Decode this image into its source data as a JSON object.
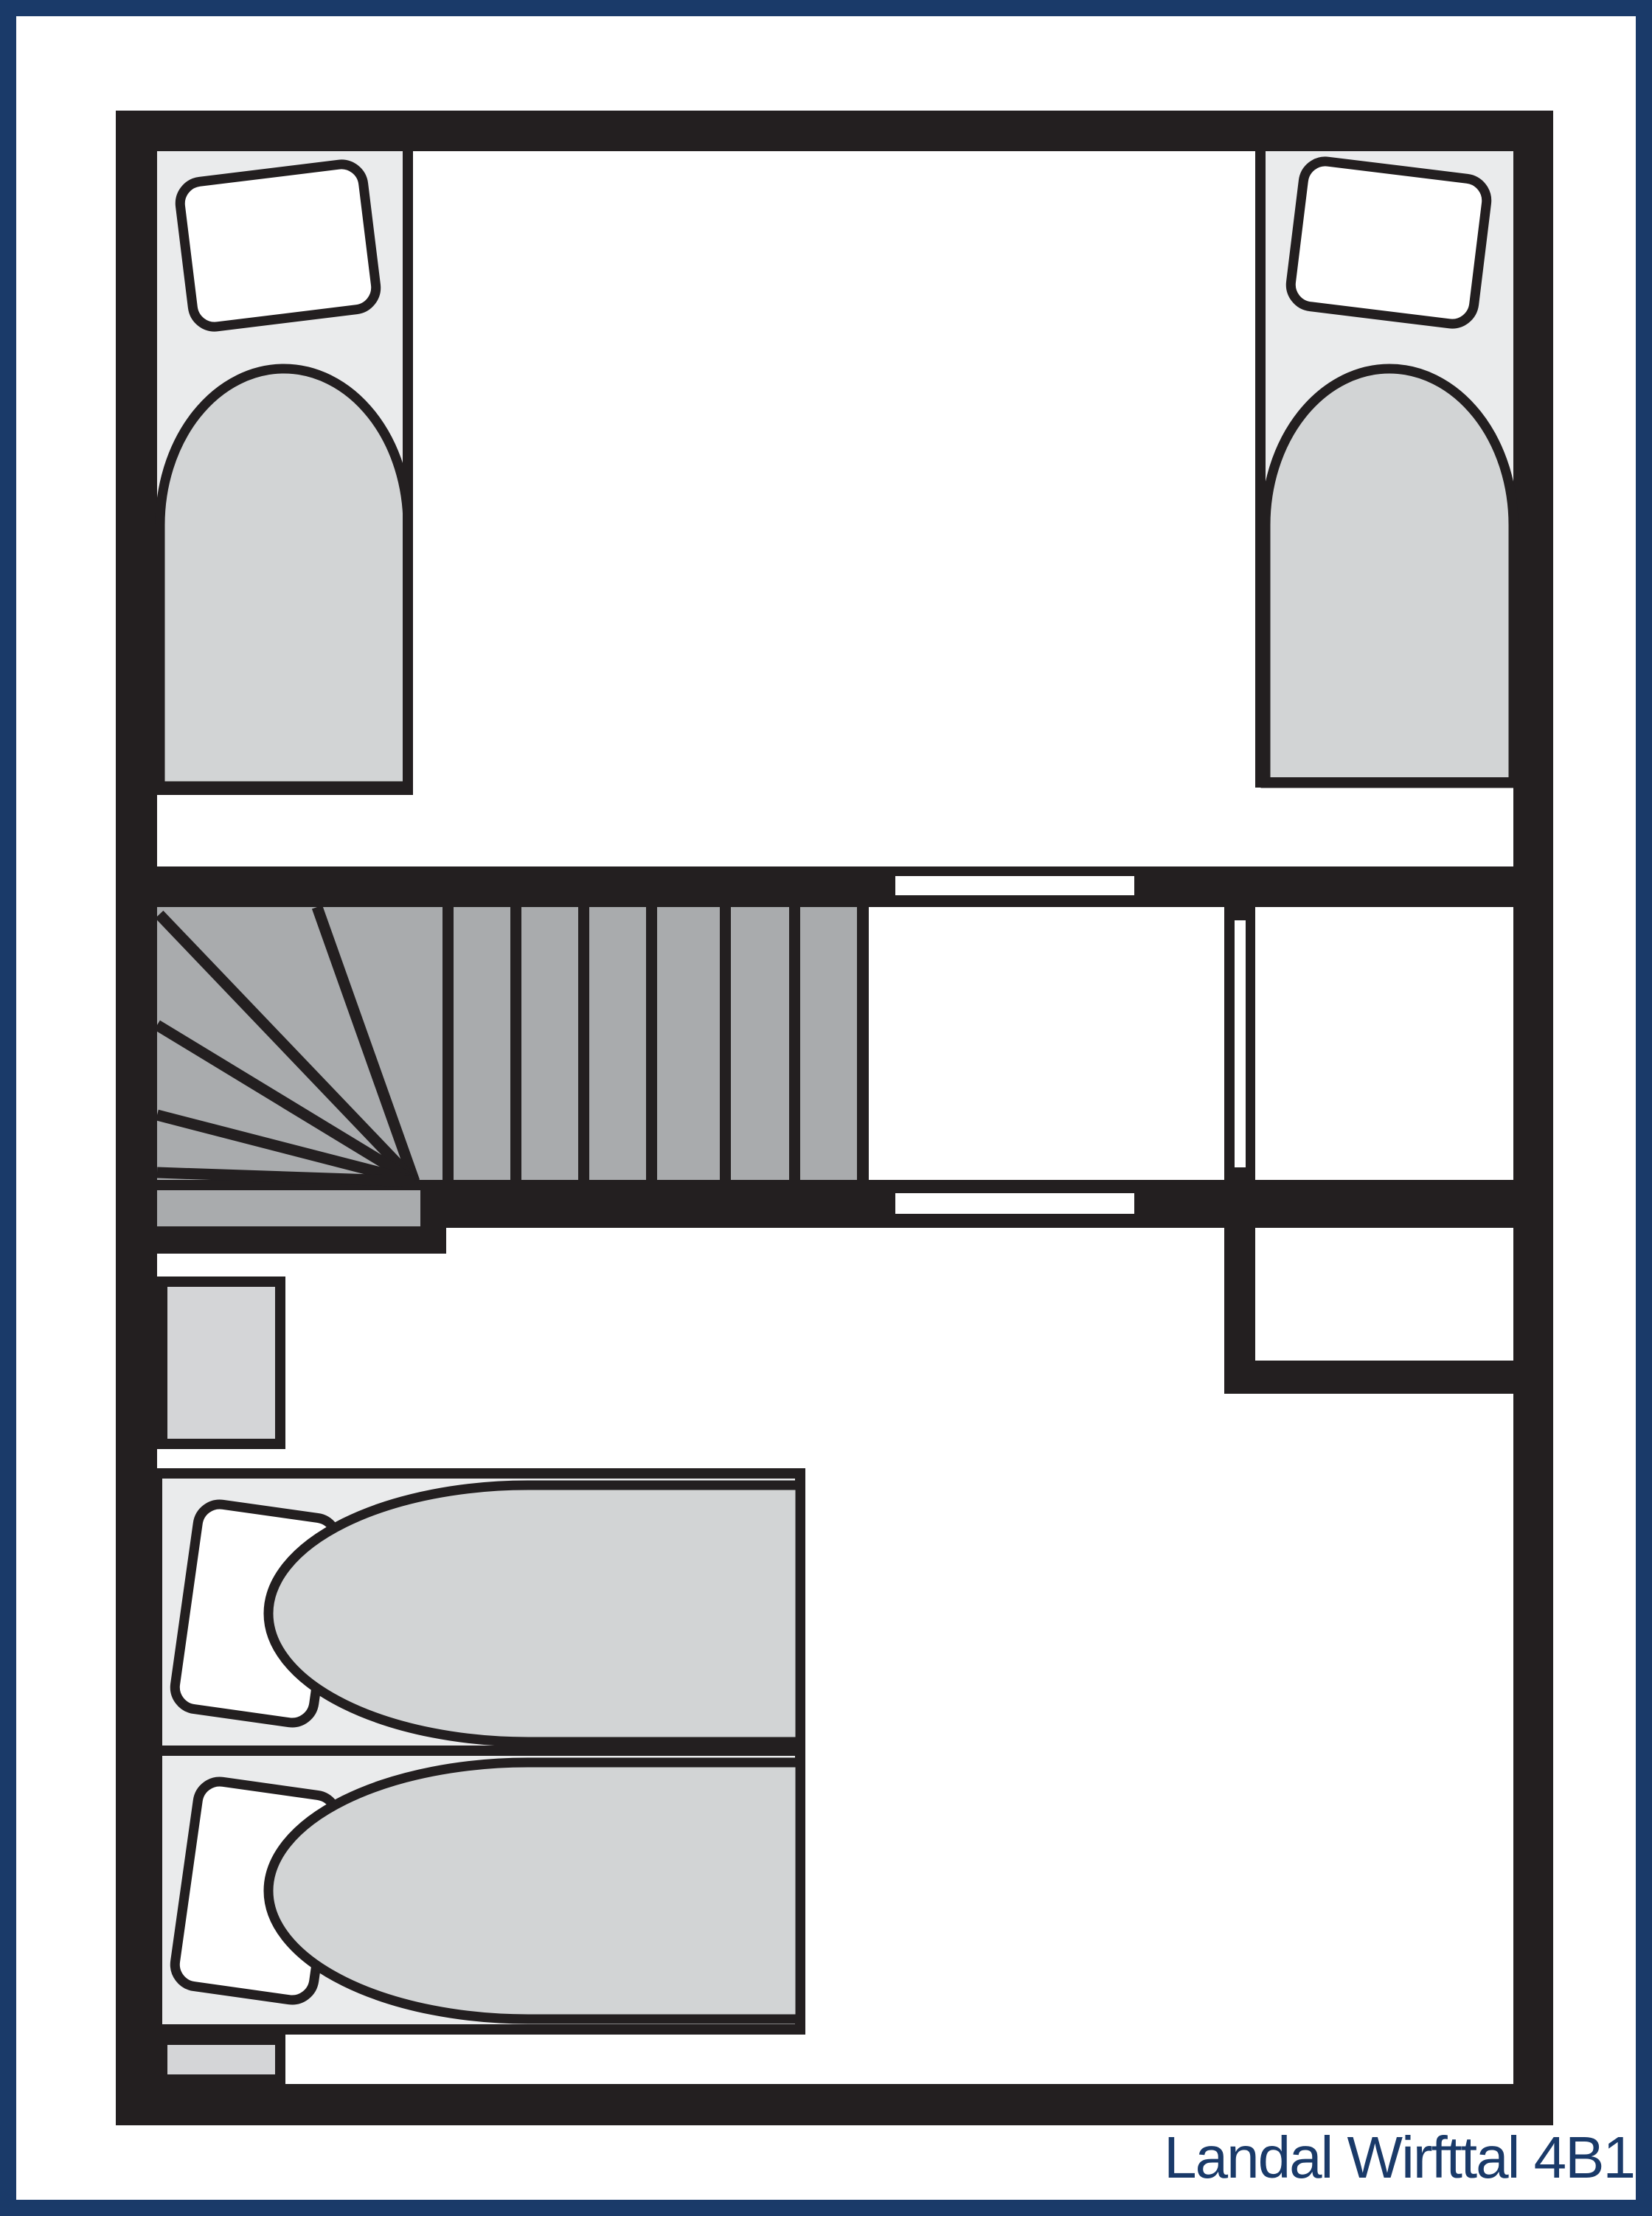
{
  "title": "Landal Wirfttal 4B1",
  "colors": {
    "ink": "#231f20",
    "navy": "#1a3a69",
    "stair": "#a9abad",
    "mattress": "#d2d4d5",
    "bedbg": "#eaebec",
    "stand": "#d4d5d7",
    "paper": "#ffffff"
  },
  "floorplan": {
    "rooms": [
      "top-bedroom",
      "stair-landing-room",
      "middle-room",
      "small-closet-room",
      "hall",
      "bottom-bedroom"
    ],
    "furniture": [
      "single-bed-top-left",
      "single-bed-top-right",
      "double-bed-lower-left",
      "nightstand-upper",
      "nightstand-lower",
      "winder-staircase"
    ],
    "door_openings": 3,
    "straight_stair_treads": 7,
    "winder_treads": 6
  }
}
